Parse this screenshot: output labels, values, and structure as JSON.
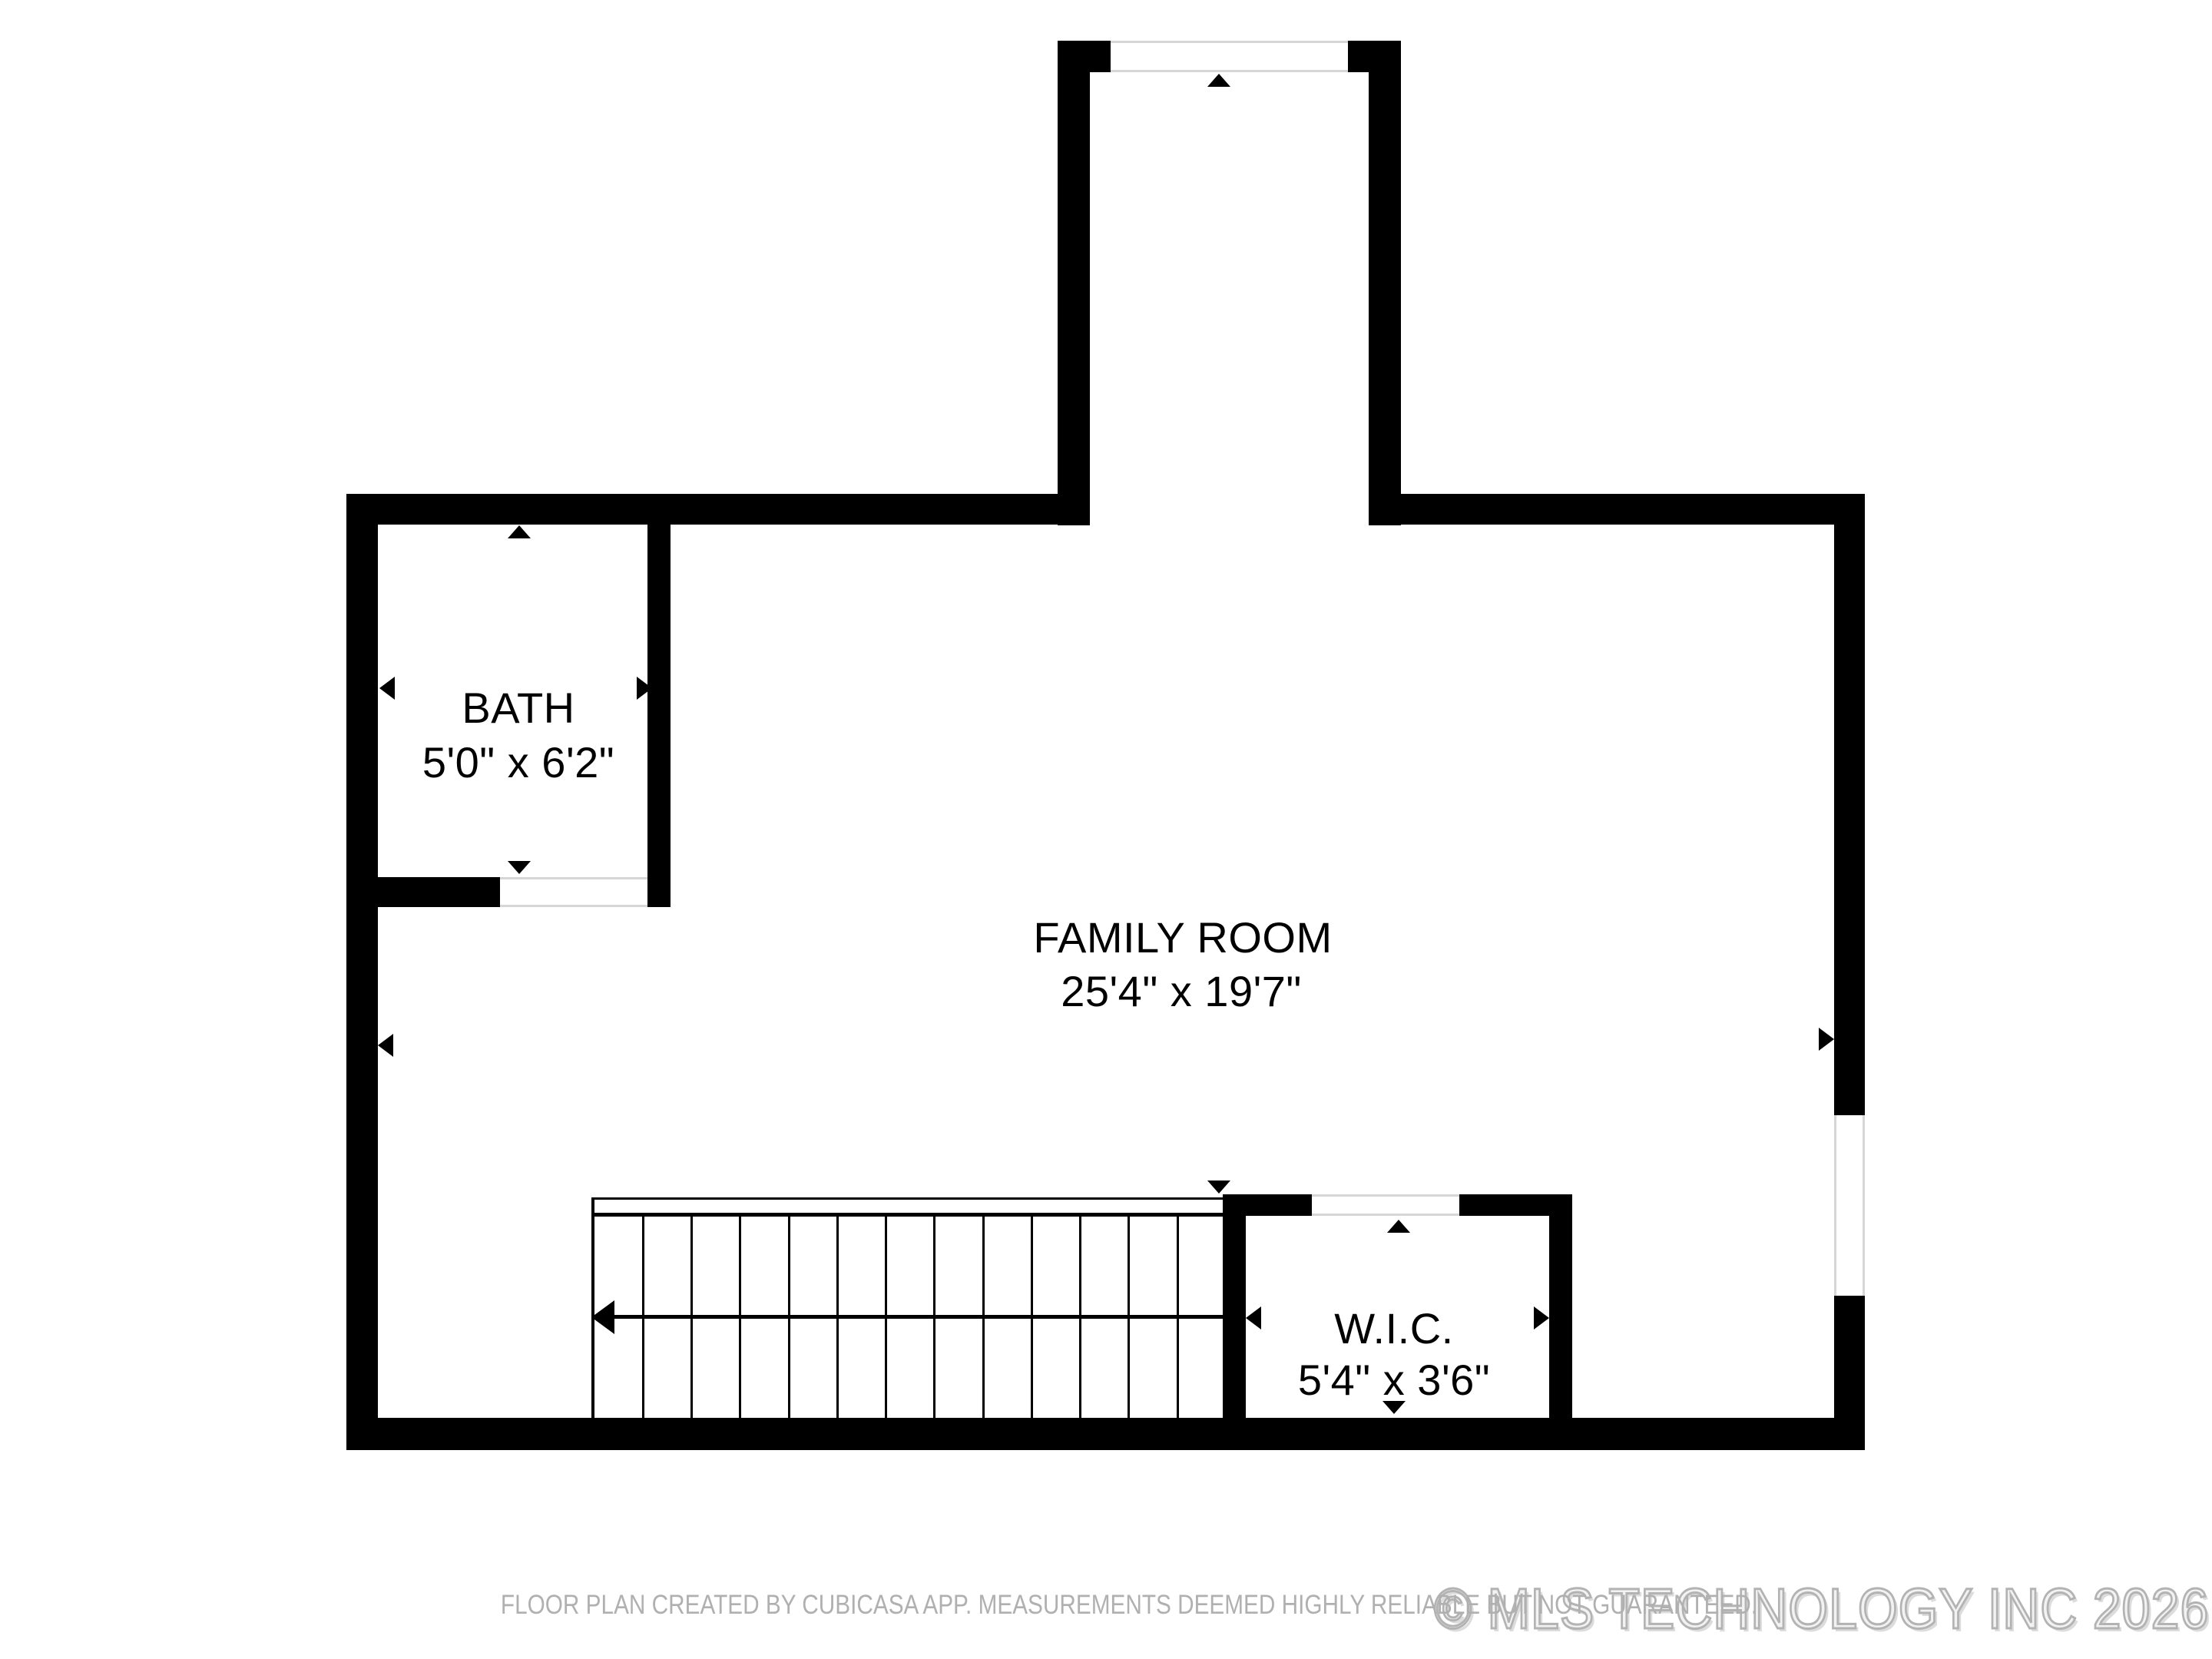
{
  "rooms": {
    "bath": {
      "name": "BATH",
      "dimensions": "5'0\" x 6'2\""
    },
    "family_room": {
      "name": "FAMILY ROOM",
      "dimensions": "25'4\" x 19'7\""
    },
    "wic": {
      "name": "W.I.C.",
      "dimensions": "5'4\" x 3'6\""
    }
  },
  "stairs": {
    "tread_count": 13
  },
  "footer": {
    "disclaimer": "FLOOR PLAN CREATED BY CUBICASA APP. MEASUREMENTS DEEMED HIGHLY RELIABLE BUT NOT GUARANTEED.",
    "watermark": "© MLS TECHNOLOGY INC 2026"
  },
  "colors": {
    "wall": "#000000",
    "opening_line": "#d6d6d6",
    "disclaimer_text": "#b0b0b0",
    "watermark_text": "#b3b3b3",
    "background": "#ffffff"
  }
}
